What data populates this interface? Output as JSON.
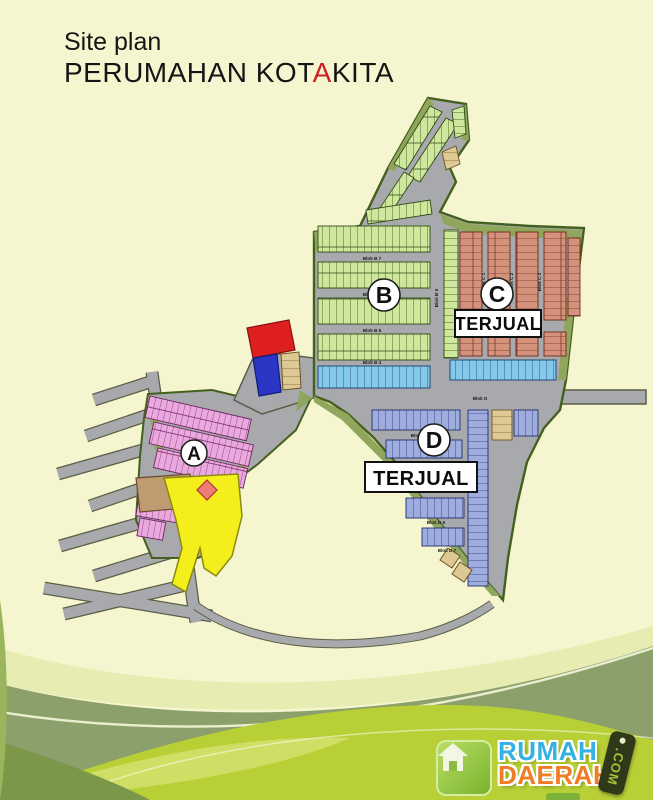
{
  "title": {
    "line1": "Site plan",
    "line2_prefix": "PERUMAHAN KOT",
    "line2_accent": "A",
    "line2_suffix": "KITA",
    "accent_color": "#cc2020"
  },
  "map": {
    "section_a": "A",
    "section_b": "B",
    "section_c": "C",
    "section_d": "D",
    "terjual_c": "TERJUAL",
    "terjual_d": "TERJUAL",
    "road_labels": {
      "b7": "Blok B 7",
      "b6": "Blok B 6",
      "b5": "Blok B 5",
      "b4": "Blok B 4",
      "b9": "Blok B 9",
      "c1": "Blok C 1",
      "c2": "Blok C 2",
      "c3": "Blok C 3",
      "c4": "Blok C 4",
      "d": "Blok D",
      "d4": "Blok D 4",
      "d6": "Blok D 6",
      "d7": "Blok D 7"
    },
    "legend_colors": {
      "section_a_lots": "#eaa9de",
      "section_b_lots": "#cfe79c",
      "section_c_lots": "#d4927c",
      "section_d_lots": "#9fadde",
      "blue_row_lots": "#84c9ea",
      "road": "#a7a9ac",
      "estate_edge_green": "#90a65c",
      "facility_red": "#dd1f1f",
      "facility_blue": "#2b36c4",
      "facility_yellow": "#f4ef1c"
    }
  },
  "logo": {
    "word1": "RUMAH",
    "word2": "DAERAH",
    "tag": ".COM"
  }
}
